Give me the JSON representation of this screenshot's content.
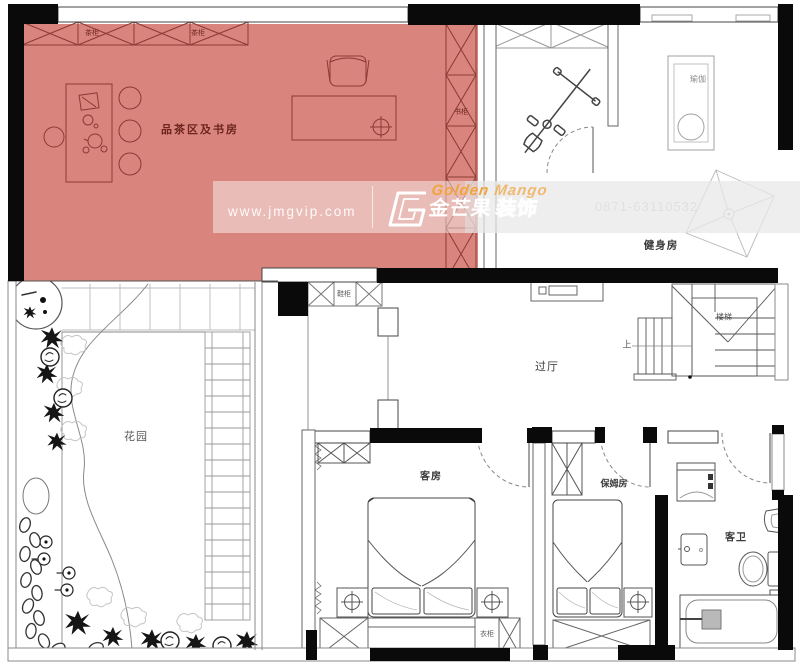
{
  "highlight_zone": {
    "label": "品茶区及书房",
    "color": "#d9857d"
  },
  "labels": {
    "tea_cabinet_a": "茶柜",
    "tea_cabinet_b": "茶柜",
    "bookcase": "书柜",
    "gym": "健身房",
    "yoga": "瑜伽",
    "hallway": "过厅",
    "stairs": "楼梯",
    "stairs_up": "上",
    "garden": "花园",
    "guest_room": "客房",
    "nanny_room": "保姆房",
    "guest_bath": "客卫",
    "wardrobe": "衣柜",
    "shoe_cabinet": "鞋柜"
  },
  "watermark": {
    "url": "www.jmgvip.com",
    "brand_en_1": "Golden",
    "brand_en_2": "Mango",
    "brand_cn": "金芒果",
    "brand_suffix": "装饰",
    "phone": "0871-63110532",
    "accent_color": "#f0a43c"
  },
  "colors": {
    "highlight": "#d9857d",
    "wall": "#000000",
    "line": "#555555"
  }
}
